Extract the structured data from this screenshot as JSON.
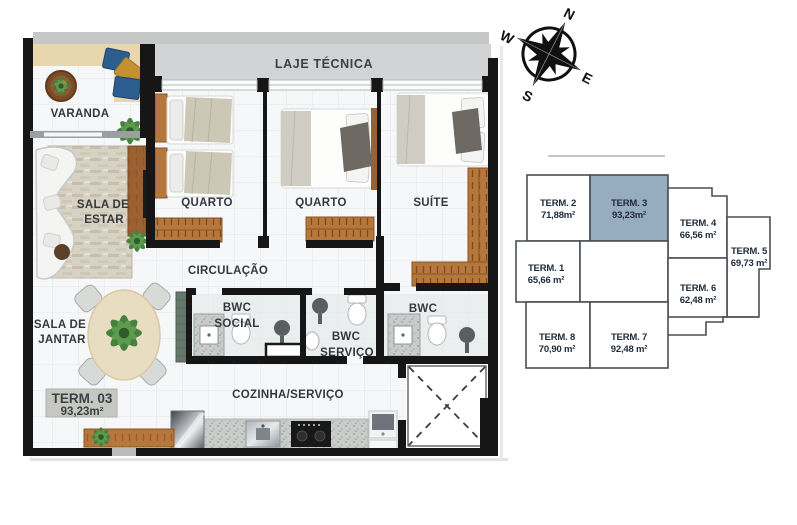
{
  "floor_plan": {
    "unit_box": {
      "title": "TERM. 03",
      "area": "93,23m²"
    },
    "labels": {
      "laje_tecnica": "LAJE TÉCNICA",
      "varanda": "VARANDA",
      "sala_estar_l1": "SALA DE",
      "sala_estar_l2": "ESTAR",
      "quarto": "QUARTO",
      "suite": "SUÍTE",
      "circulacao": "CIRCULAÇÃO",
      "sala_jantar_l1": "SALA DE",
      "sala_jantar_l2": "JANTAR",
      "bwc_social_l1": "BWC",
      "bwc_social_l2": "SOCIAL",
      "bwc_servico_l1": "BWC",
      "bwc_servico_l2": "SERVIÇO",
      "bwc_suite": "BWC",
      "cozinha_servico": "COZINHA/SERVIÇO"
    },
    "colors": {
      "wall": "#161616",
      "laje_band": "#d2d3d4",
      "wood": "#a8692f"
    }
  },
  "compass": {
    "north": "N",
    "east": "E",
    "south": "S",
    "west": "W"
  },
  "key_plan": {
    "highlight_color": "#96acbf",
    "units": [
      {
        "name": "TERM. 2",
        "area": "71,88m²",
        "highlighted": false
      },
      {
        "name": "TERM. 3",
        "area": "93,23m²",
        "highlighted": true
      },
      {
        "name": "TERM. 4",
        "area": "66,56 m²",
        "highlighted": false
      },
      {
        "name": "TERM. 5",
        "area": "69,73 m²",
        "highlighted": false
      },
      {
        "name": "TERM. 1",
        "area": "65,66 m²",
        "highlighted": false
      },
      {
        "name": "TERM. 6",
        "area": "62,48 m²",
        "highlighted": false
      },
      {
        "name": "TERM. 8",
        "area": "70,90 m²",
        "highlighted": false
      },
      {
        "name": "TERM. 7",
        "area": "92,48 m²",
        "highlighted": false
      }
    ]
  }
}
